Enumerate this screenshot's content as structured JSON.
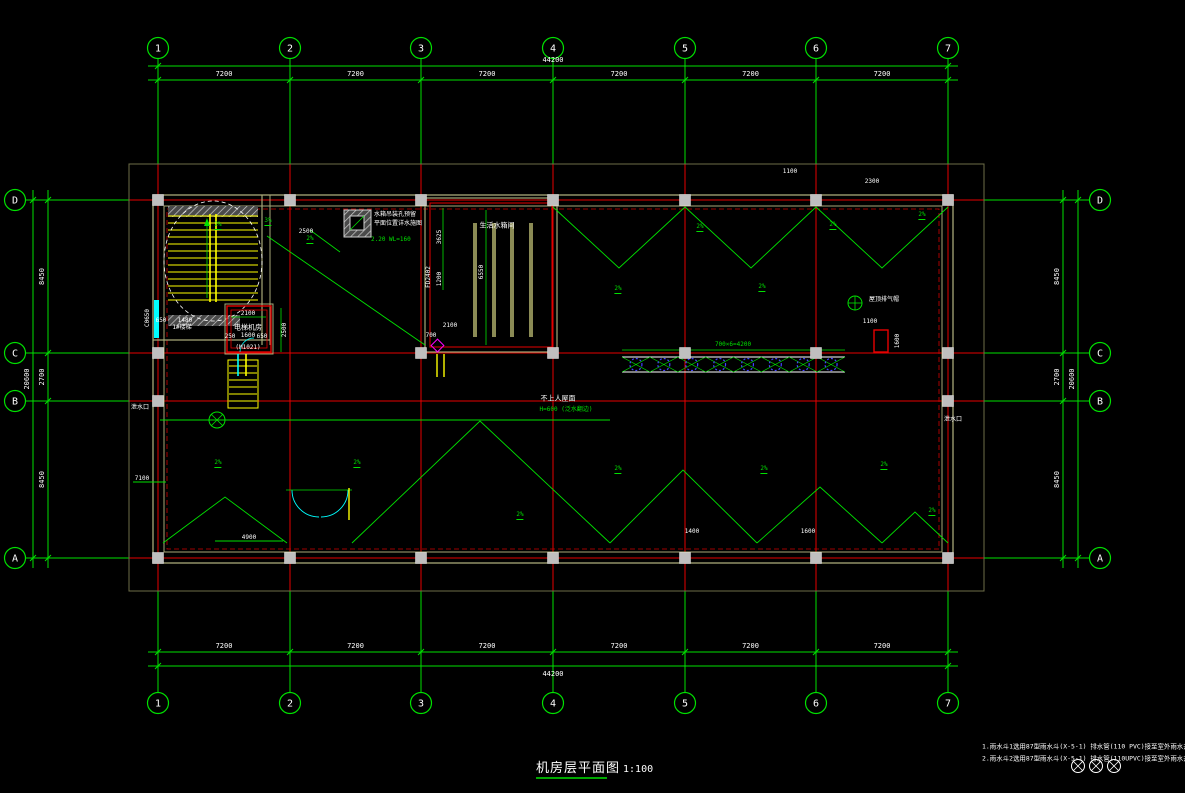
{
  "title": {
    "text": "机房层平面图",
    "scale": "1:100"
  },
  "notes": {
    "line1": "1.雨水斗1选用87型雨水斗(X-5-1) 排水管(110 PVC)接至室外雨水井(详见水施图)",
    "line2": "2.雨水斗2选用87型雨水斗(X-5-1) 排水管(110UPVC)接至室外雨水井(详见水施图)"
  },
  "colors": {
    "background": "#000000",
    "line_green": "#00E100",
    "grid_red": "#E60000",
    "text_white": "#FFFFFF",
    "stair_yellow": "#FFFF00",
    "window_cyan": "#00FFFF",
    "wall_olive": "#A8A878",
    "column_gray": "#BFBFBF",
    "marker_blue": "#4444FF",
    "detail_magenta": "#FF00FF"
  },
  "grid": {
    "cols": [
      {
        "label": "1",
        "x": 158
      },
      {
        "label": "2",
        "x": 290
      },
      {
        "label": "3",
        "x": 421
      },
      {
        "label": "4",
        "x": 553
      },
      {
        "label": "5",
        "x": 685
      },
      {
        "label": "6",
        "x": 816
      },
      {
        "label": "7",
        "x": 948
      }
    ],
    "rows": [
      {
        "label": "D",
        "y": 200
      },
      {
        "label": "C",
        "y": 353
      },
      {
        "label": "B",
        "y": 401
      },
      {
        "label": "A",
        "y": 558
      }
    ]
  },
  "dims": {
    "top_bays": [
      "7200",
      "7200",
      "7200",
      "7200",
      "7200",
      "7200"
    ],
    "top_total": "44200",
    "bottom_bays": [
      "7200",
      "7200",
      "7200",
      "7200",
      "7200",
      "7200"
    ],
    "bottom_total": "44200",
    "left_bays": [
      "8450",
      "2700",
      "8450"
    ],
    "left_total": "20600",
    "right_bays": [
      "8450",
      "2700",
      "8450"
    ],
    "right_total": "20600"
  },
  "rooms": {
    "stair": {
      "label": "1#楼梯",
      "window_tag": "C0650"
    },
    "elevator": {
      "label": "电梯机房",
      "door_tag": "(M1021)"
    },
    "tank": {
      "label": "生活水箱间"
    }
  },
  "walkway": {
    "segments": 8,
    "dim": "700×6=4200"
  },
  "labels": [
    {
      "t": "电梯机房",
      "x": 248,
      "y": 328,
      "c": "w",
      "s": 7
    },
    {
      "t": "1600",
      "x": 248,
      "y": 336,
      "c": "w",
      "s": 6
    },
    {
      "t": "(M1021)",
      "x": 248,
      "y": 348,
      "c": "w",
      "s": 6
    },
    {
      "t": "2100",
      "x": 248,
      "y": 314,
      "c": "w",
      "s": 6
    },
    {
      "t": "2500",
      "x": 285,
      "y": 330,
      "c": "w",
      "s": 6,
      "r": 1
    },
    {
      "t": "250",
      "x": 230,
      "y": 337,
      "c": "w",
      "s": 6
    },
    {
      "t": "650",
      "x": 262,
      "y": 337,
      "c": "w",
      "s": 6
    },
    {
      "t": "1#楼梯",
      "x": 182,
      "y": 328,
      "c": "w",
      "s": 6
    },
    {
      "t": "650",
      "x": 161,
      "y": 321,
      "c": "w",
      "s": 6
    },
    {
      "t": "1480",
      "x": 185,
      "y": 321,
      "c": "w",
      "s": 6
    },
    {
      "t": "C0650",
      "x": 148,
      "y": 318,
      "c": "w",
      "s": 6,
      "r": 1
    },
    {
      "t": "水箱吊装孔预留",
      "x": 374,
      "y": 215,
      "c": "w",
      "s": 6,
      "a": "left"
    },
    {
      "t": "平面位置详水施图",
      "x": 374,
      "y": 224,
      "c": "w",
      "s": 6,
      "a": "left"
    },
    {
      "t": "2.20 WL=160",
      "x": 371,
      "y": 240,
      "c": "g",
      "s": 6,
      "a": "left"
    },
    {
      "t": "生活水箱间",
      "x": 497,
      "y": 226,
      "c": "w",
      "s": 7
    },
    {
      "t": "6550",
      "x": 482,
      "y": 272,
      "c": "w",
      "s": 6,
      "r": 1
    },
    {
      "t": "3625",
      "x": 440,
      "y": 237,
      "c": "w",
      "s": 6,
      "r": 1
    },
    {
      "t": "1200",
      "x": 440,
      "y": 279,
      "c": "w",
      "s": 6,
      "r": 1
    },
    {
      "t": "FD2402",
      "x": 429,
      "y": 277,
      "c": "w",
      "s": 6,
      "r": 1
    },
    {
      "t": "2100",
      "x": 450,
      "y": 326,
      "c": "w",
      "s": 6
    },
    {
      "t": "700",
      "x": 431,
      "y": 336,
      "c": "w",
      "s": 6
    },
    {
      "t": "不上人屋面",
      "x": 558,
      "y": 399,
      "c": "w",
      "s": 7
    },
    {
      "t": "H=600 (泛水翻边)",
      "x": 566,
      "y": 410,
      "c": "g",
      "s": 6
    },
    {
      "t": "700×6=4200",
      "x": 733,
      "y": 345,
      "c": "g",
      "s": 6
    },
    {
      "t": "屋顶排气帽",
      "x": 884,
      "y": 300,
      "c": "w",
      "s": 6
    },
    {
      "t": "1600",
      "x": 898,
      "y": 341,
      "c": "w",
      "s": 6,
      "r": 1
    },
    {
      "t": "1100",
      "x": 870,
      "y": 322,
      "c": "w",
      "s": 6
    },
    {
      "t": "泄水口",
      "x": 140,
      "y": 408,
      "c": "w",
      "s": 6
    },
    {
      "t": "泄水口",
      "x": 953,
      "y": 420,
      "c": "w",
      "s": 6
    },
    {
      "t": "7100",
      "x": 142,
      "y": 479,
      "c": "w",
      "s": 6
    },
    {
      "t": "4900",
      "x": 249,
      "y": 538,
      "c": "w",
      "s": 6
    },
    {
      "t": "1400",
      "x": 692,
      "y": 532,
      "c": "w",
      "s": 6
    },
    {
      "t": "1600",
      "x": 808,
      "y": 532,
      "c": "w",
      "s": 6
    },
    {
      "t": "2500",
      "x": 306,
      "y": 232,
      "c": "w",
      "s": 6
    },
    {
      "t": "2300",
      "x": 872,
      "y": 182,
      "c": "w",
      "s": 6
    },
    {
      "t": "1100",
      "x": 790,
      "y": 172,
      "c": "w",
      "s": 6
    },
    {
      "t": "3%",
      "x": 268,
      "y": 222,
      "c": "g",
      "s": 6,
      "cls": "slope"
    },
    {
      "t": "2%",
      "x": 218,
      "y": 226,
      "c": "g",
      "s": 6,
      "cls": "slope"
    },
    {
      "t": "2%",
      "x": 310,
      "y": 240,
      "c": "g",
      "s": 6,
      "cls": "slope"
    },
    {
      "t": "2%",
      "x": 618,
      "y": 290,
      "c": "g",
      "s": 6,
      "cls": "slope"
    },
    {
      "t": "2%",
      "x": 700,
      "y": 228,
      "c": "g",
      "s": 6,
      "cls": "slope"
    },
    {
      "t": "2%",
      "x": 762,
      "y": 288,
      "c": "g",
      "s": 6,
      "cls": "slope"
    },
    {
      "t": "2%",
      "x": 833,
      "y": 226,
      "c": "g",
      "s": 6,
      "cls": "slope"
    },
    {
      "t": "2%",
      "x": 922,
      "y": 216,
      "c": "g",
      "s": 6,
      "cls": "slope"
    },
    {
      "t": "2%",
      "x": 218,
      "y": 464,
      "c": "g",
      "s": 6,
      "cls": "slope"
    },
    {
      "t": "2%",
      "x": 357,
      "y": 464,
      "c": "g",
      "s": 6,
      "cls": "slope"
    },
    {
      "t": "2%",
      "x": 520,
      "y": 516,
      "c": "g",
      "s": 6,
      "cls": "slope"
    },
    {
      "t": "2%",
      "x": 618,
      "y": 470,
      "c": "g",
      "s": 6,
      "cls": "slope"
    },
    {
      "t": "2%",
      "x": 764,
      "y": 470,
      "c": "g",
      "s": 6,
      "cls": "slope"
    },
    {
      "t": "2%",
      "x": 884,
      "y": 466,
      "c": "g",
      "s": 6,
      "cls": "slope"
    },
    {
      "t": "2%",
      "x": 932,
      "y": 512,
      "c": "g",
      "s": 6,
      "cls": "slope"
    }
  ]
}
